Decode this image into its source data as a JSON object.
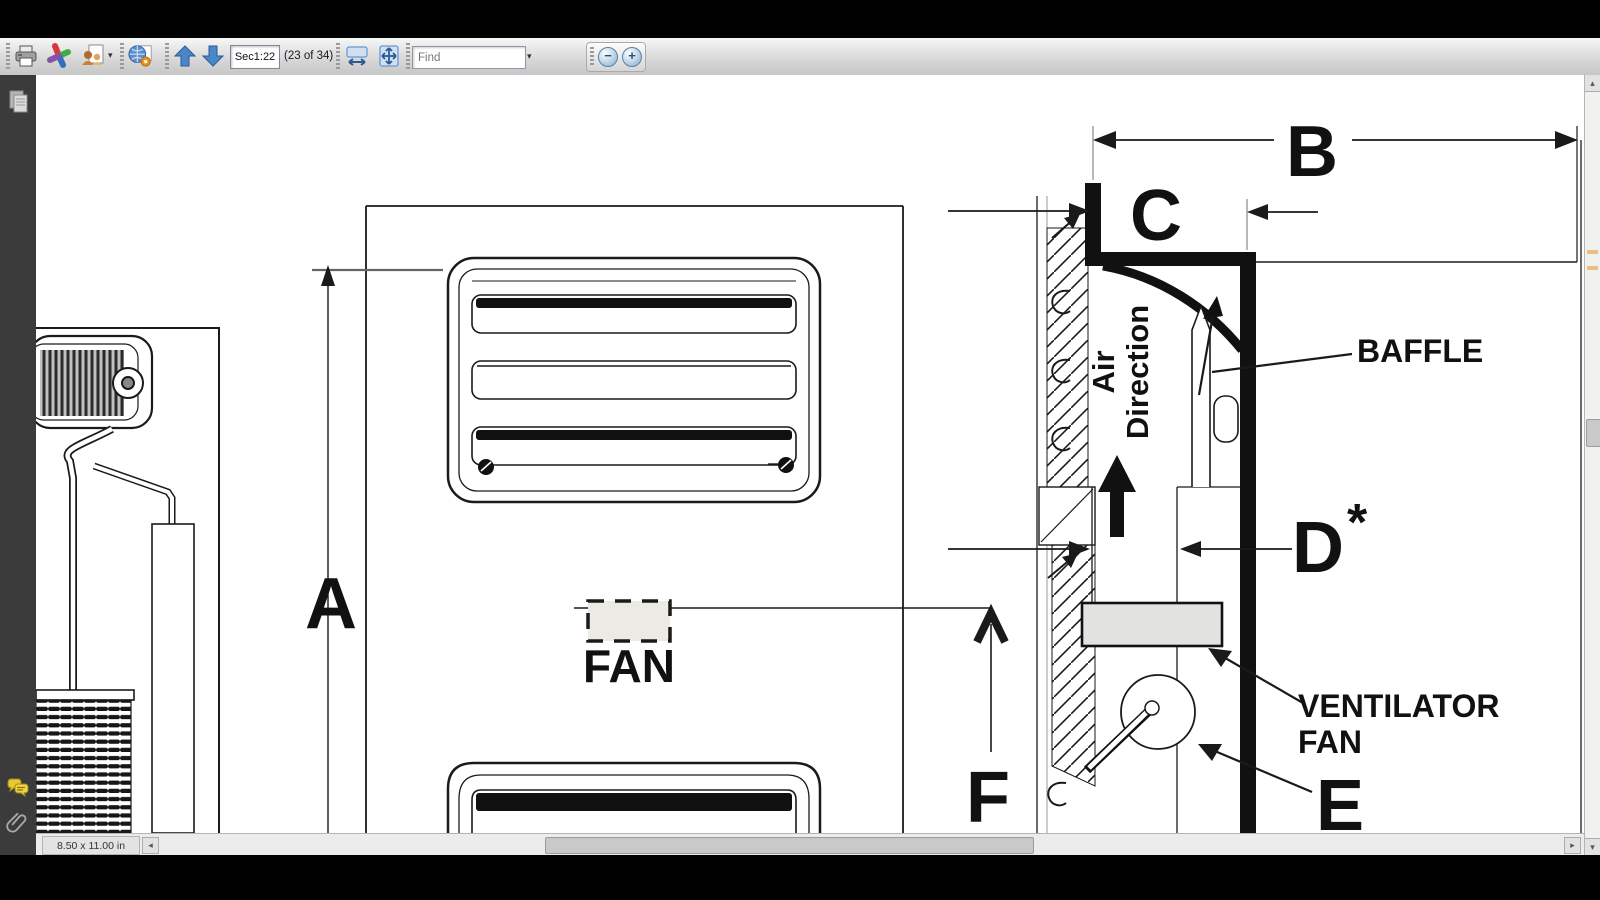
{
  "toolbar": {
    "page_field_value": "Sec1:22",
    "page_count_label": "(23 of 34)",
    "find_placeholder": "Find",
    "zoom_out_glyph": "−",
    "zoom_in_glyph": "+",
    "dropdown_caret": "▾"
  },
  "statusbar": {
    "page_size": "8.50 x 11.00 in",
    "scroll_left_glyph": "◂",
    "scroll_right_glyph": "▸"
  },
  "vscroll": {
    "up_glyph": "▴",
    "down_glyph": "▾"
  },
  "drawing": {
    "labels": {
      "a": "A",
      "b": "B",
      "c": "C",
      "d": "D",
      "d_star": "*",
      "e": "E",
      "f": "F",
      "fan": "FAN",
      "baffle": "BAFFLE",
      "ventilator_line1": "VENTILATOR",
      "ventilator_line2": "FAN",
      "air_line1": "Air",
      "air_line2": "Direction"
    }
  },
  "icons": {
    "print": "printer-icon",
    "review": "pinwheel-icon",
    "collaborate": "people-page-icon",
    "shared_review": "globe-page-icon",
    "prev_page": "up-arrow-icon",
    "next_page": "down-arrow-icon",
    "fit_width": "fit-width-icon",
    "fit_page": "fit-page-icon",
    "pages_panel": "pages-icon",
    "comments_panel": "comments-icon",
    "attachments_panel": "paperclip-icon"
  },
  "colors": {
    "accent_blue": "#4a86c8",
    "sidebar_bg": "#3b3b3b",
    "annotation_orange": "#e8a33d",
    "drawing_ink": "#1a1a1a"
  }
}
